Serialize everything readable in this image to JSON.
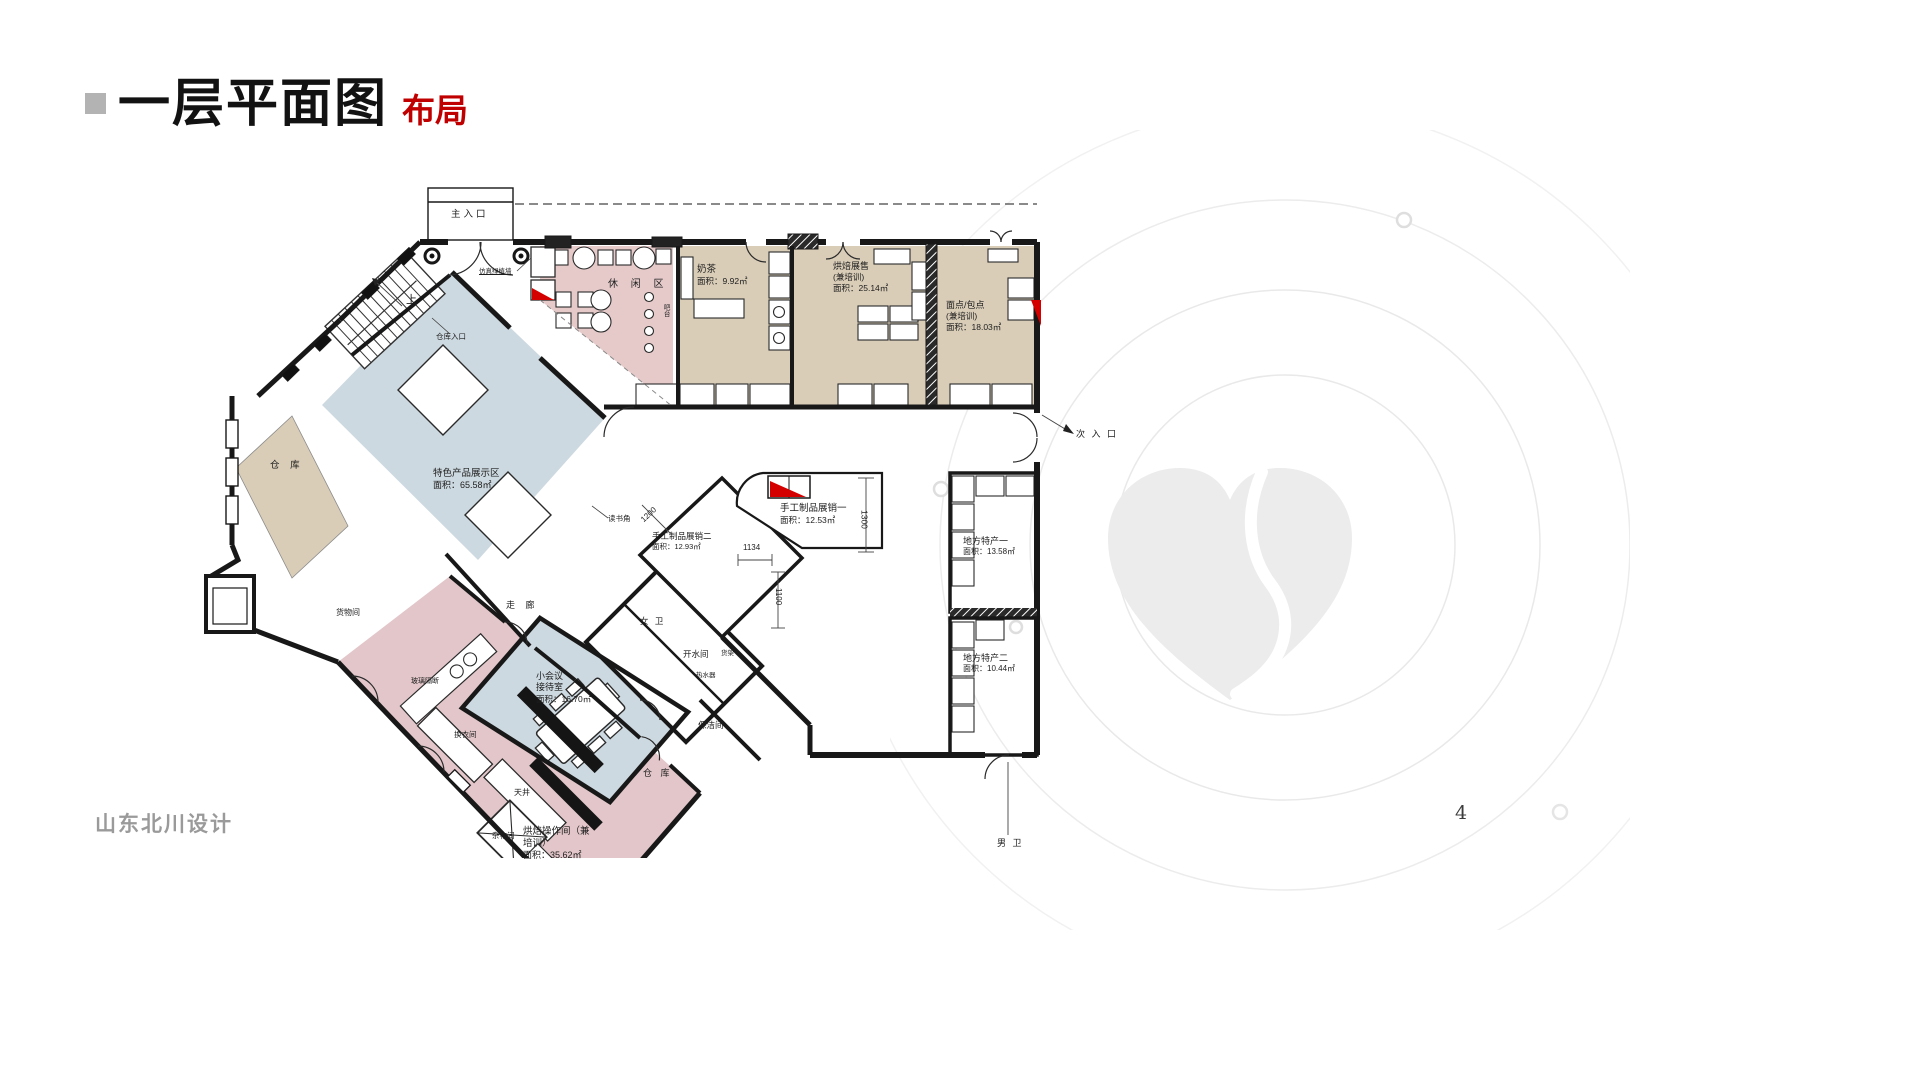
{
  "slide": {
    "title": "一层平面图",
    "subtitle": "布局",
    "footer_company": "山东北川设计",
    "page_number": "4",
    "colors": {
      "accent_red": "#c00000",
      "title_black": "#121212",
      "footer_gray": "#9a9a9a"
    }
  },
  "plan": {
    "colors": {
      "leisure_pink": "#e6caca",
      "room_tan": "#d9cdb8",
      "display_blue": "#cdd9e0",
      "workshop_pink": "#e2c6c9",
      "wall_black": "#181818",
      "red_accent": "#d40000"
    },
    "entrances": {
      "main": "主入口",
      "secondary": "次 入 口",
      "warehouse_entry": "仓库入口"
    },
    "stair_up": "上",
    "zones": {
      "leisure": {
        "name": "休 闲 区"
      },
      "milk_tea": {
        "name": "奶茶",
        "area": "面积：9.92㎡"
      },
      "baking_display": {
        "name": "烘焙展售",
        "sub": "(兼培训)",
        "area": "面积：25.14㎡"
      },
      "pastry": {
        "name": "面点/包点",
        "sub": "(兼培训)",
        "area": "面积：18.03㎡"
      },
      "handicraft_1": {
        "name": "手工制品展销一",
        "area": "面积：12.53㎡"
      },
      "local_specialty_1": {
        "name": "地方特产一",
        "area": "面积：13.58㎡"
      },
      "local_specialty_2": {
        "name": "地方特产二",
        "area": "面积：10.44㎡"
      },
      "featured_display": {
        "name": "特色产品展示区",
        "area": "面积：65.58㎡"
      },
      "handicraft_2": {
        "name": "手工制品展销二",
        "area": "面积：12.93㎡"
      },
      "meeting": {
        "name": "小会议",
        "name2": "接待室",
        "area": "面积：16.70㎡"
      },
      "baking_workshop": {
        "name": "烘焙操作间（兼",
        "name2": "培训）",
        "area": "面积：35.62㎡"
      },
      "warehouse_left": "仓  库",
      "warehouse_mid": "仓 库",
      "goods_room": "货物间",
      "corridor": "走 廊",
      "womens_wc": "女 卫",
      "mens_wc": "男 卫",
      "hot_water": "开水间",
      "cleaning": "保洁间",
      "changing": "换衣间",
      "courtyard": "天井",
      "sundry": "杂物间"
    },
    "small_notes": {
      "green_wall": "仿真绿植墙",
      "glass_partition": "玻璃隔断",
      "reading_corner": "读书角",
      "bar_counter": "吧台",
      "shelf": "货架",
      "water_heater": "热水器"
    },
    "dimensions": {
      "d1300": "1300",
      "d1134": "1134",
      "d1200": "1200",
      "d1100": "1100"
    }
  }
}
